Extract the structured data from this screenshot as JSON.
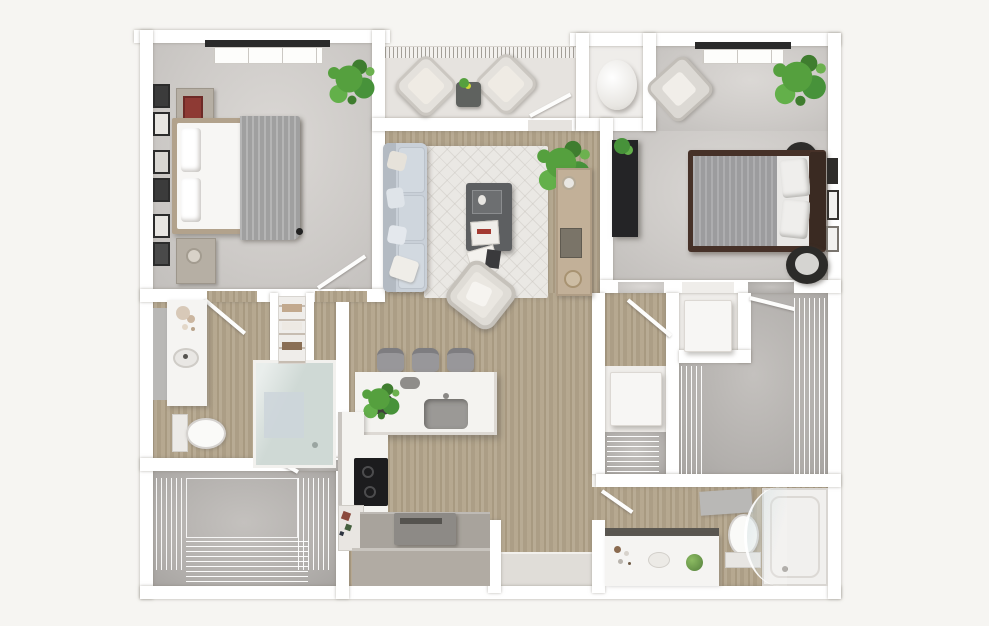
{
  "scene": {
    "kind": "3d-top-down-floor-plan-render",
    "text_visible": "none",
    "rooms": [
      {
        "id": "bedroom-1",
        "furniture": [
          "queen-bed",
          "nightstand",
          "nightstand",
          "wall-art-frames",
          "potted-plant",
          "ceiling-light"
        ]
      },
      {
        "id": "balcony",
        "furniture": [
          "lounge-chair",
          "lounge-chair",
          "side-table"
        ]
      },
      {
        "id": "utility-closet",
        "furniture": [
          "water-heater"
        ]
      },
      {
        "id": "bedroom-2",
        "furniture": [
          "queen-bed",
          "black-dresser",
          "armchair",
          "potted-plant",
          "pouf",
          "round-chair",
          "ceiling-light",
          "wall-art-frames"
        ]
      },
      {
        "id": "living-room",
        "furniture": [
          "sofa",
          "area-rug",
          "coffee-table",
          "console-table",
          "lounge-chair",
          "potted-plant"
        ]
      },
      {
        "id": "kitchen",
        "furniture": [
          "island-with-sink",
          "bar-stool",
          "bar-stool",
          "bar-stool",
          "cooktop",
          "counter",
          "small-appliance",
          "base-cabinets",
          "island-plant"
        ]
      },
      {
        "id": "bathroom-1",
        "furniture": [
          "vanity-with-sink",
          "mirror",
          "toilet",
          "walk-in-shower",
          "linen-shelves"
        ]
      },
      {
        "id": "walk-in-closet-1",
        "furniture": [
          "wire-shelving",
          "hanging-clothes"
        ]
      },
      {
        "id": "hallway",
        "furniture": [
          "washer",
          "dryer",
          "coat-shelf"
        ]
      },
      {
        "id": "walk-in-closet-2",
        "furniture": [
          "wire-shelving",
          "hanging-clothes"
        ]
      },
      {
        "id": "bathroom-2",
        "furniture": [
          "vanity-with-sink",
          "mirror",
          "toilet",
          "tub-shower-with-glass"
        ]
      },
      {
        "id": "entry",
        "furniture": [
          "floor-mat"
        ]
      }
    ]
  },
  "palette": {
    "canvas_bg": "#f6f5f2",
    "wall": "#ffffff",
    "wood_floor": "#b3a58c",
    "bedroom_floor": "#cdcac7",
    "closet_floor": "#b2afac",
    "balcony_floor": "#e6e3df",
    "utility_floor": "#efedea",
    "entry_mat": "#e0ddd8",
    "rug": "#eae8e4",
    "sofa": "#c9d0d8",
    "sofa_back": "#b3bac2",
    "pillow": "#e3e7ec",
    "coffee_table": "#5d5f61",
    "console_wood": "#c2b098",
    "counter_white": "#f4f3f0",
    "counter_gray": "#a8a39c",
    "base_cabinet": "#b1aba3",
    "stool": "#98979a",
    "cooktop": "#1c1c1e",
    "machine": "#8d8a86",
    "appliance_white": "#f7f6f4",
    "plant_green": "#55a03e",
    "bed1_frame": "#b2a28c",
    "bed1_linen": "#f7f6f4",
    "bed1_throw": "#a9a9a9",
    "bed2_frame": "#463128",
    "bed2_headboard": "#3a2a22",
    "bed2_blanket": "#a2a2a4",
    "bed2_sheet": "#e9e8e6",
    "dresser_black": "#242426",
    "pouf_black": "#2e2d2b",
    "shower_glass": "#cfd9d5",
    "bath_mat": "#ccd5da",
    "fixture_white": "#fafaf8",
    "vanity_white": "#f5f4f2",
    "vanity_backsplash": "#5a5751",
    "mirror_gray": "#b9b8b6",
    "tub_white": "#f1f0ee"
  }
}
